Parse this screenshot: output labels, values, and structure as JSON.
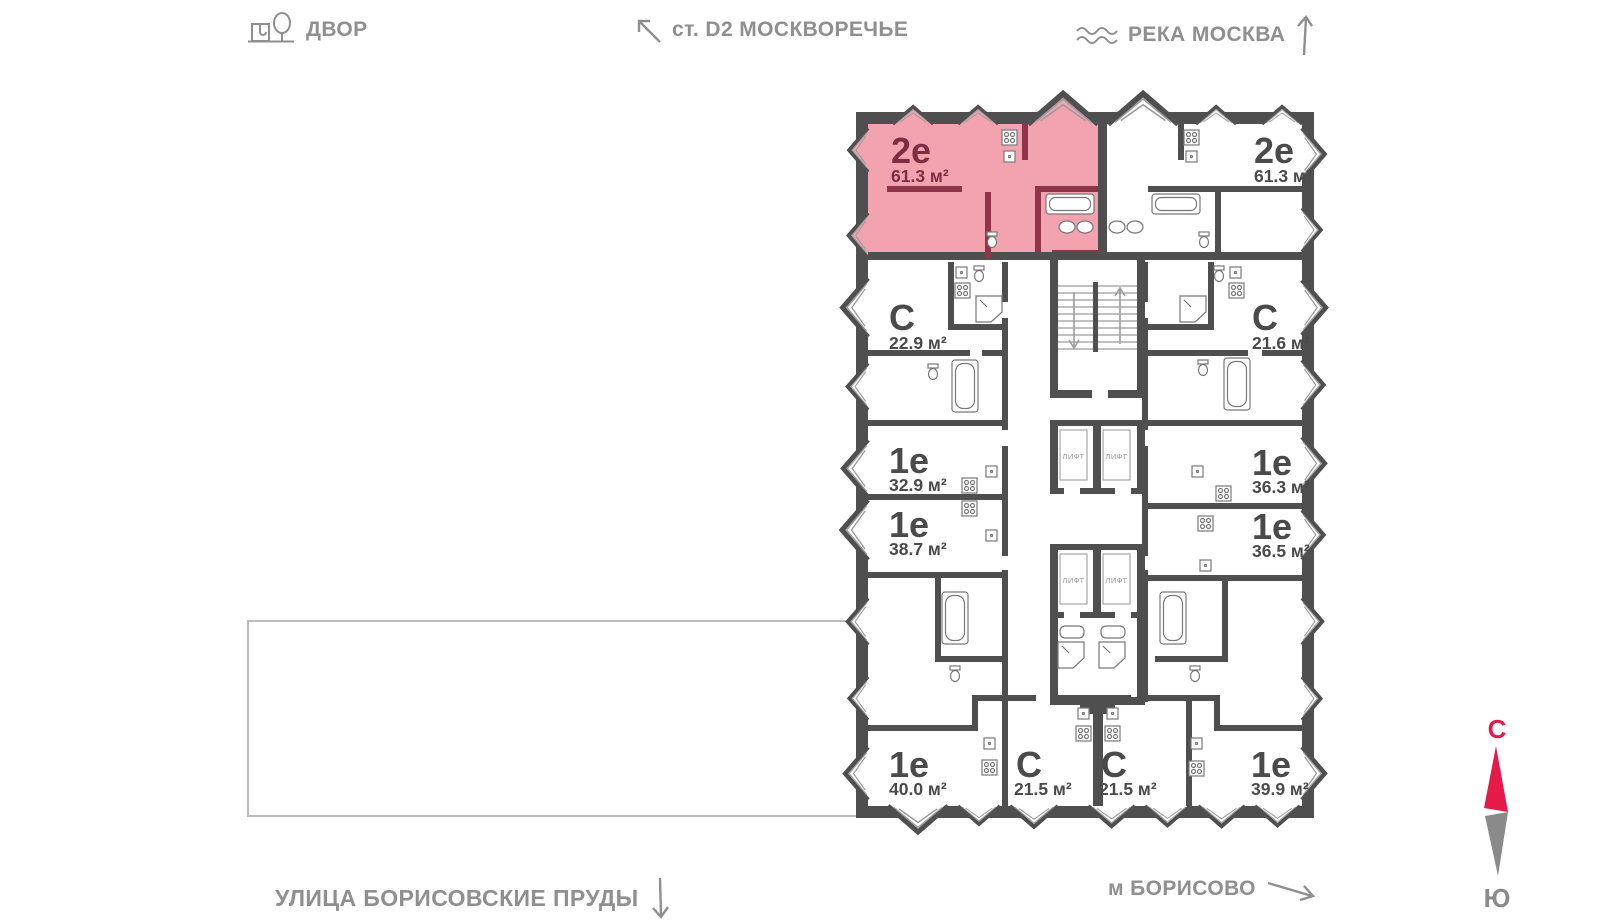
{
  "map_labels": {
    "yard": "ДВОР",
    "station": "ст. D2 МОСКВОРЕЧЬЕ",
    "river": "РЕКА МОСКВА",
    "street": "УЛИЦА БОРИСОВСКИЕ ПРУДЫ",
    "metro": "м БОРИСОВО"
  },
  "icons": {
    "yard": "tree-bench-icon",
    "station_arrow": "arrow-up-left-icon",
    "river": "waves-icon",
    "river_arrow": "arrow-up-icon",
    "street_arrow": "arrow-down-icon",
    "metro_arrow": "arrow-down-right-icon"
  },
  "compass": {
    "north": "С",
    "south": "Ю",
    "north_color": "#e51a4b",
    "south_color": "#8a8a8a"
  },
  "floorplan": {
    "elevator_label": "ЛИФТ",
    "colors": {
      "wall": "#4f4f4f",
      "highlight_fill": "#f3a3af",
      "highlight_wall": "#8f3449",
      "accent_red": "#e51a4b"
    },
    "apartments": [
      {
        "type": "2е",
        "area": "61.3 м²",
        "highlighted": true
      },
      {
        "type": "2е",
        "area": "61.3 м²",
        "highlighted": false
      },
      {
        "type": "С",
        "area": "22.9 м²",
        "highlighted": false
      },
      {
        "type": "1е",
        "area": "32.9 м²",
        "highlighted": false
      },
      {
        "type": "1е",
        "area": "38.7 м²",
        "highlighted": false
      },
      {
        "type": "1е",
        "area": "40.0 м²",
        "highlighted": false
      },
      {
        "type": "С",
        "area": "21.5 м²",
        "highlighted": false
      },
      {
        "type": "С",
        "area": "21.5 м²",
        "highlighted": false
      },
      {
        "type": "1е",
        "area": "39.9 м²",
        "highlighted": false
      },
      {
        "type": "1е",
        "area": "36.5 м²",
        "highlighted": false
      },
      {
        "type": "1е",
        "area": "36.3 м²",
        "highlighted": false
      },
      {
        "type": "С",
        "area": "21.6 м²",
        "highlighted": false
      }
    ]
  }
}
